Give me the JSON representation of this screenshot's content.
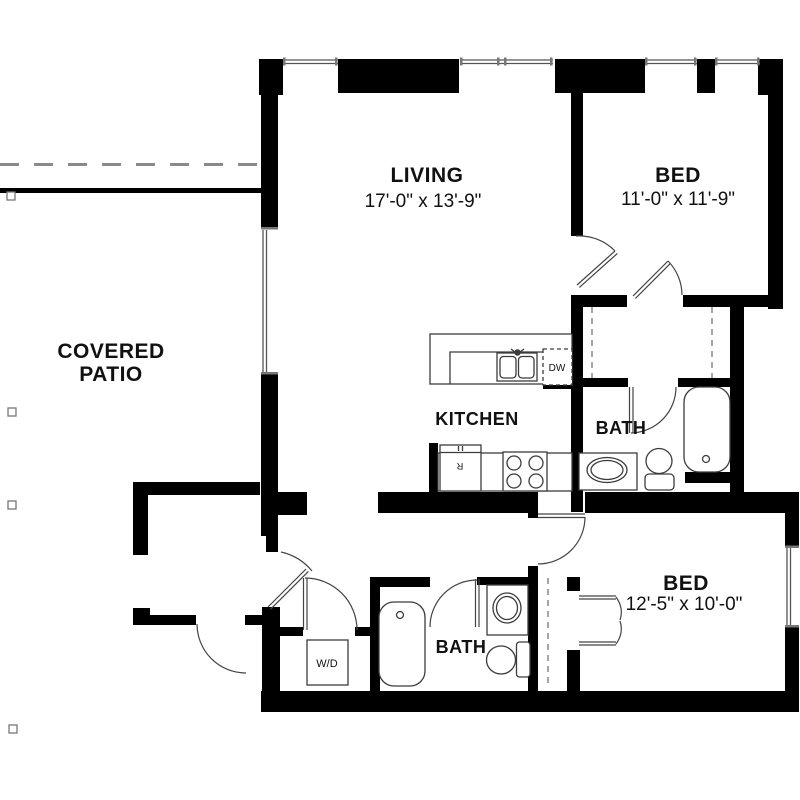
{
  "floorplan": {
    "rooms": {
      "living": {
        "name": "LIVING",
        "dims": "17'-0\" x 13'-9\""
      },
      "bed1": {
        "name": "BED",
        "dims": "11'-0\" x 11'-9\""
      },
      "bed2": {
        "name": "BED",
        "dims": "12'-5\" x 10'-0\""
      },
      "kitchen": {
        "name": "KITCHEN"
      },
      "bath1": {
        "name": "BATH"
      },
      "bath2": {
        "name": "BATH"
      },
      "patio": {
        "line1": "COVERED",
        "line2": "PATIO"
      }
    },
    "appliances": {
      "washer_dryer": "W/D",
      "dishwasher": "DW",
      "refrigerator": "R"
    },
    "colors": {
      "wall": "#000000",
      "fixture_line": "#3c3c3c",
      "dashed_line": "#8a8a8a",
      "background": "#ffffff",
      "text": "#111111"
    }
  }
}
